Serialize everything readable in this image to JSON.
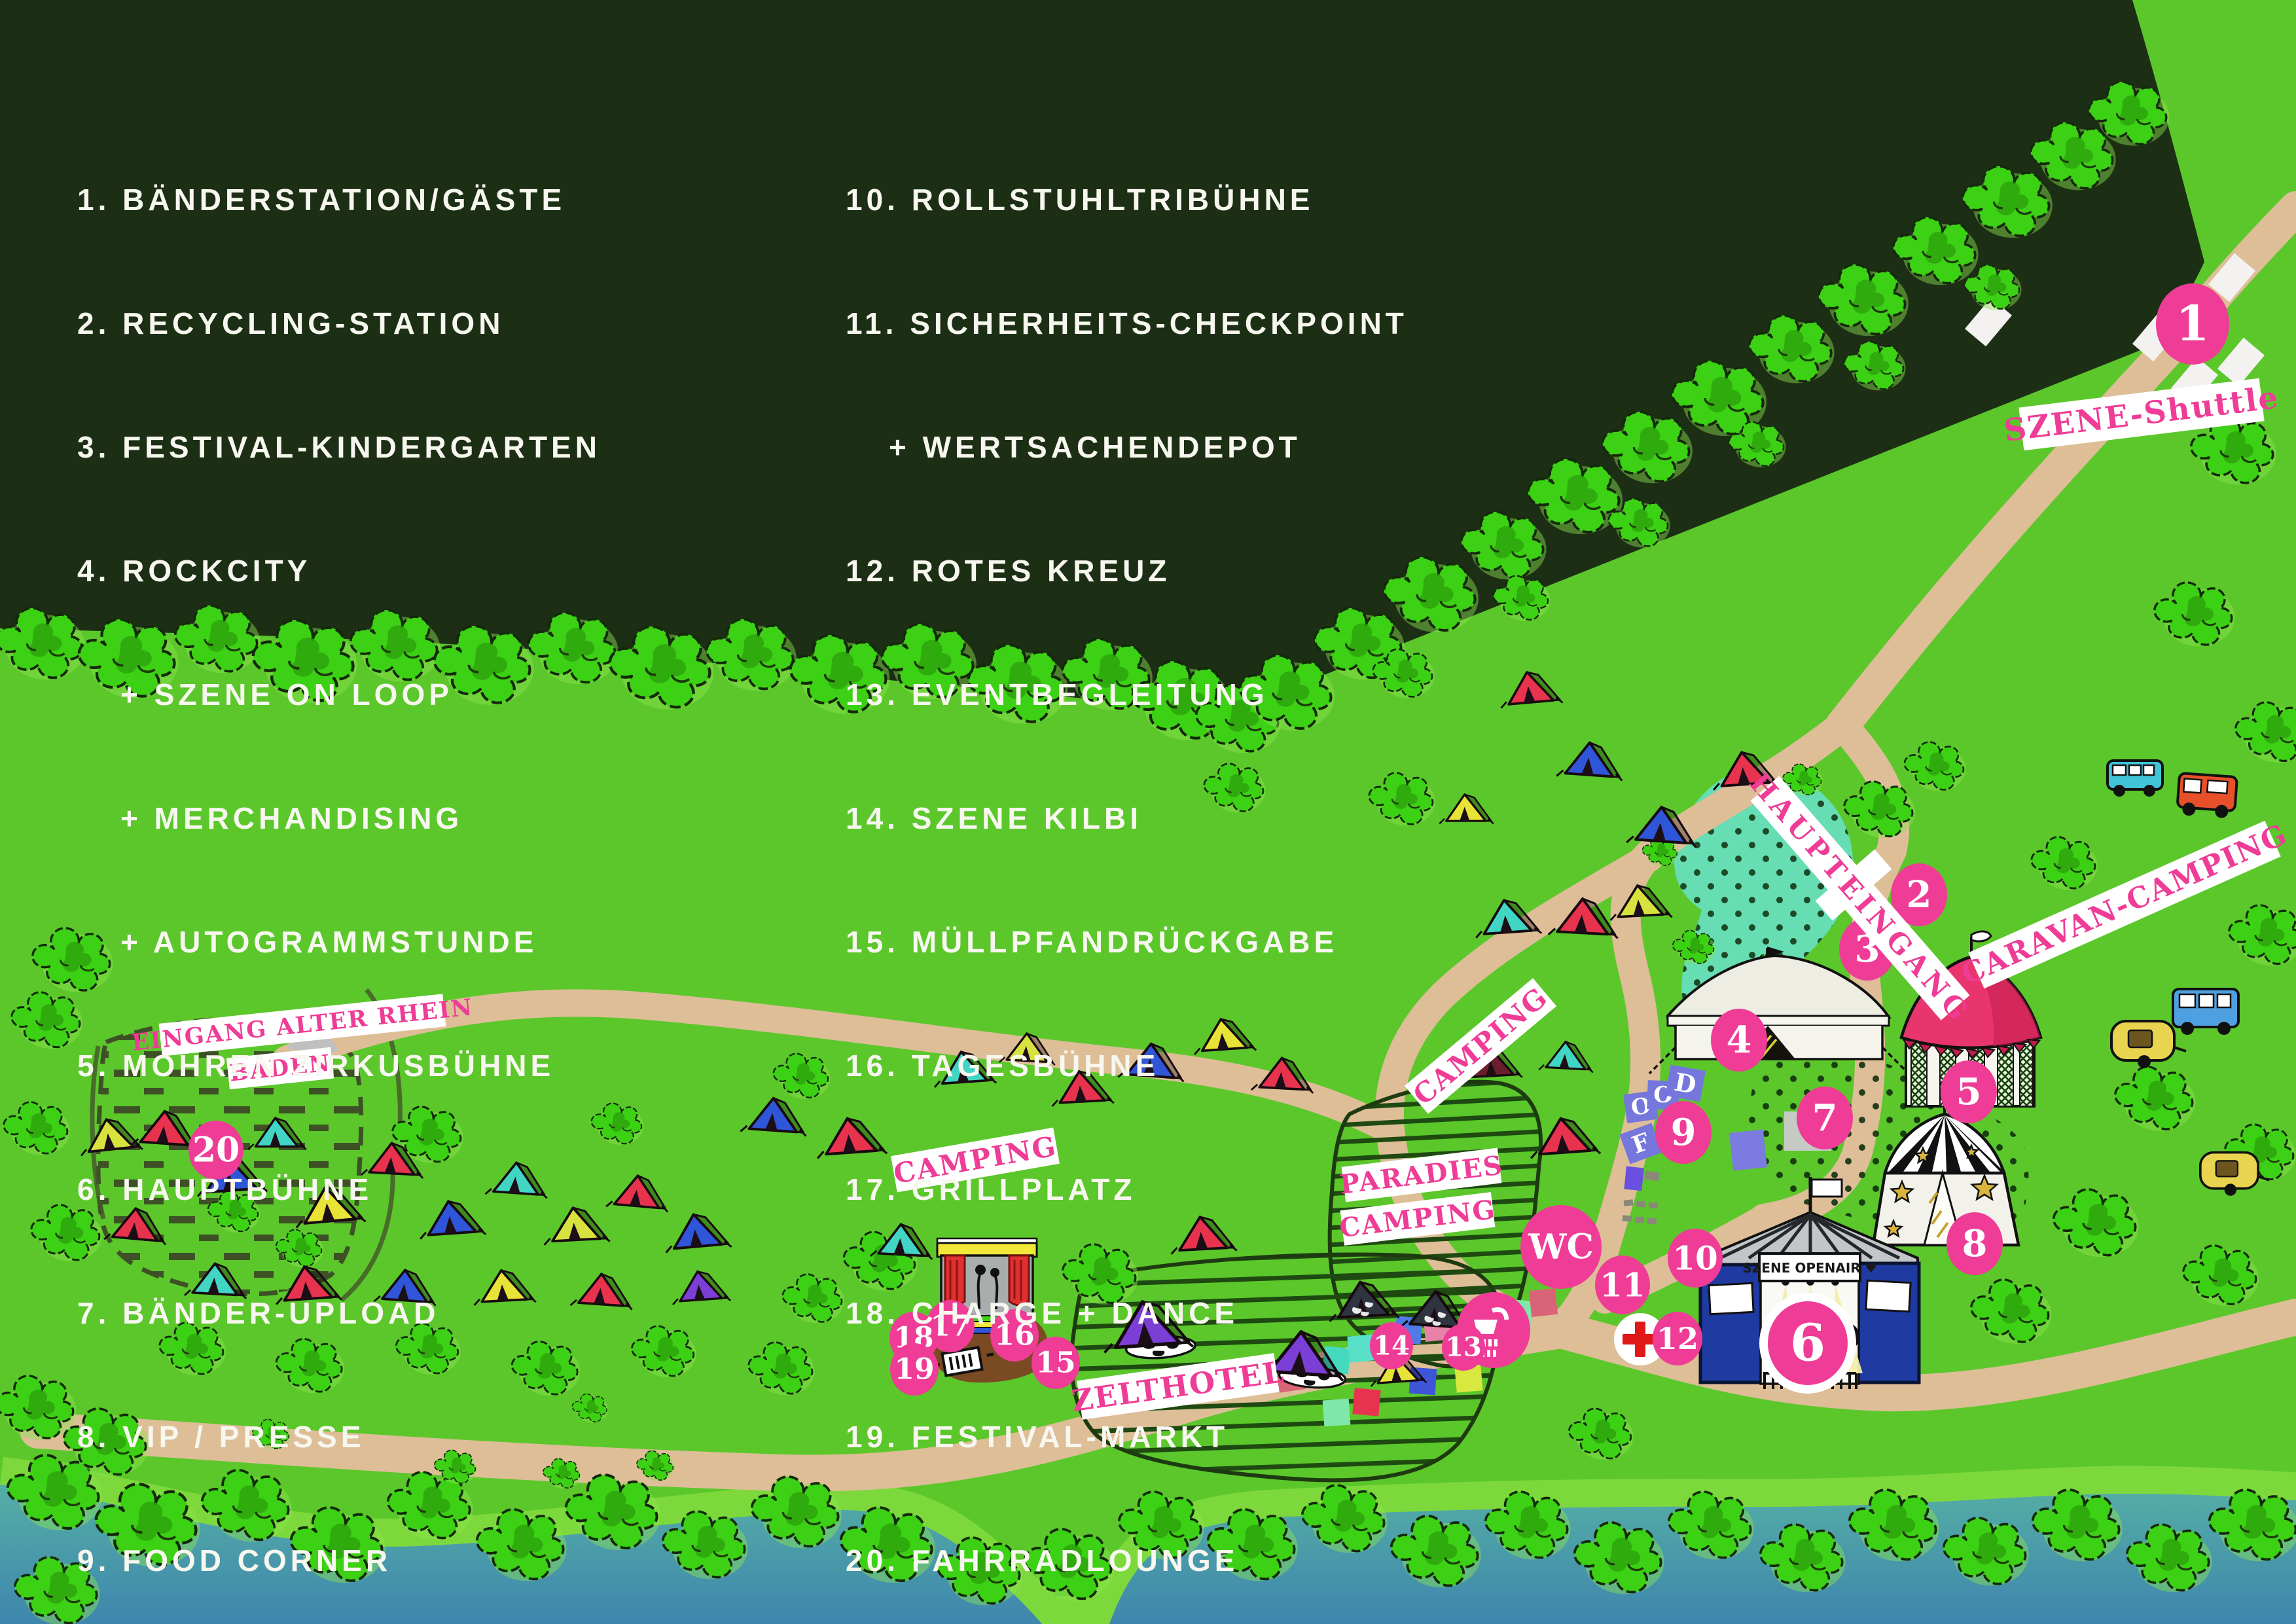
{
  "legend": {
    "col1": [
      "1. BÄNDERSTATION/GÄSTE",
      "2. RECYCLING-STATION",
      "3. FESTIVAL-KINDERGARTEN",
      "4. ROCKCITY",
      "+ SZENE ON LOOP",
      "+ MERCHANDISING",
      "+ AUTOGRAMMSTUNDE",
      "5. MOHREN ZIRKUSBÜHNE",
      "6. HAUPTBÜHNE",
      "7. BÄNDER-UPLOAD",
      "8. VIP / PRESSE",
      "9. FOOD CORNER"
    ],
    "col2": [
      "10. ROLLSTUHLTRIBÜHNE",
      "11. SICHERHEITS-CHECKPOINT",
      "+ WERTSACHENDEPOT",
      "12. ROTES KREUZ",
      "13. EVENTBEGLEITUNG",
      "14. SZENE KILBI",
      "15. MÜLLPFANDRÜCKGABE",
      "16. TAGESBÜHNE",
      "17. GRILLPLATZ",
      "18. CHARGE + DANCE",
      "19. FESTIVAL-MARKT",
      "20. FAHRRADLOUNGE"
    ]
  },
  "map": {
    "markers": [
      "1",
      "2",
      "3",
      "4",
      "5",
      "6",
      "7",
      "8",
      "9",
      "10",
      "11",
      "12",
      "13",
      "14",
      "15",
      "16",
      "17",
      "18",
      "19",
      "20"
    ],
    "labels": {
      "szene_shuttle": "SZENE-Shuttle",
      "caravan_camping": "CARAVAN-CAMPING",
      "haupteingang": "HAUPTEINGANG",
      "camping_upper": "CAMPING",
      "camping_lower": "CAMPING",
      "paradies_line1": "PARADIES",
      "paradies_line2": "CAMPING",
      "zelthotel": "ZELTHOTEL",
      "eingang_line1": "EINGANG ALTER RHEIN",
      "eingang_line2": "BADEN"
    },
    "wc_label": "WC",
    "stage_banner": "SZENE OPENAIR ♥",
    "food": [
      "F",
      "O",
      "O",
      "D"
    ],
    "grill_plus": "+",
    "grill_minus": "-",
    "icons": {
      "shower": "shower-icon",
      "red_cross": "red-cross-icon",
      "grill": "grill-icon",
      "flag": "flag-icon",
      "entrance_arrow": "entrance-arrow-icon"
    },
    "colors": {
      "pink": "#EF3C96",
      "grass_green": "#5BC72B",
      "forest_green": "#1C2F15",
      "road_tan": "#DDBE97",
      "water_top": "#58B4A3",
      "water_bottom": "#3E86AE",
      "pond_teal": "#66DDB2",
      "stage_blue": "#1F3AA0"
    }
  }
}
